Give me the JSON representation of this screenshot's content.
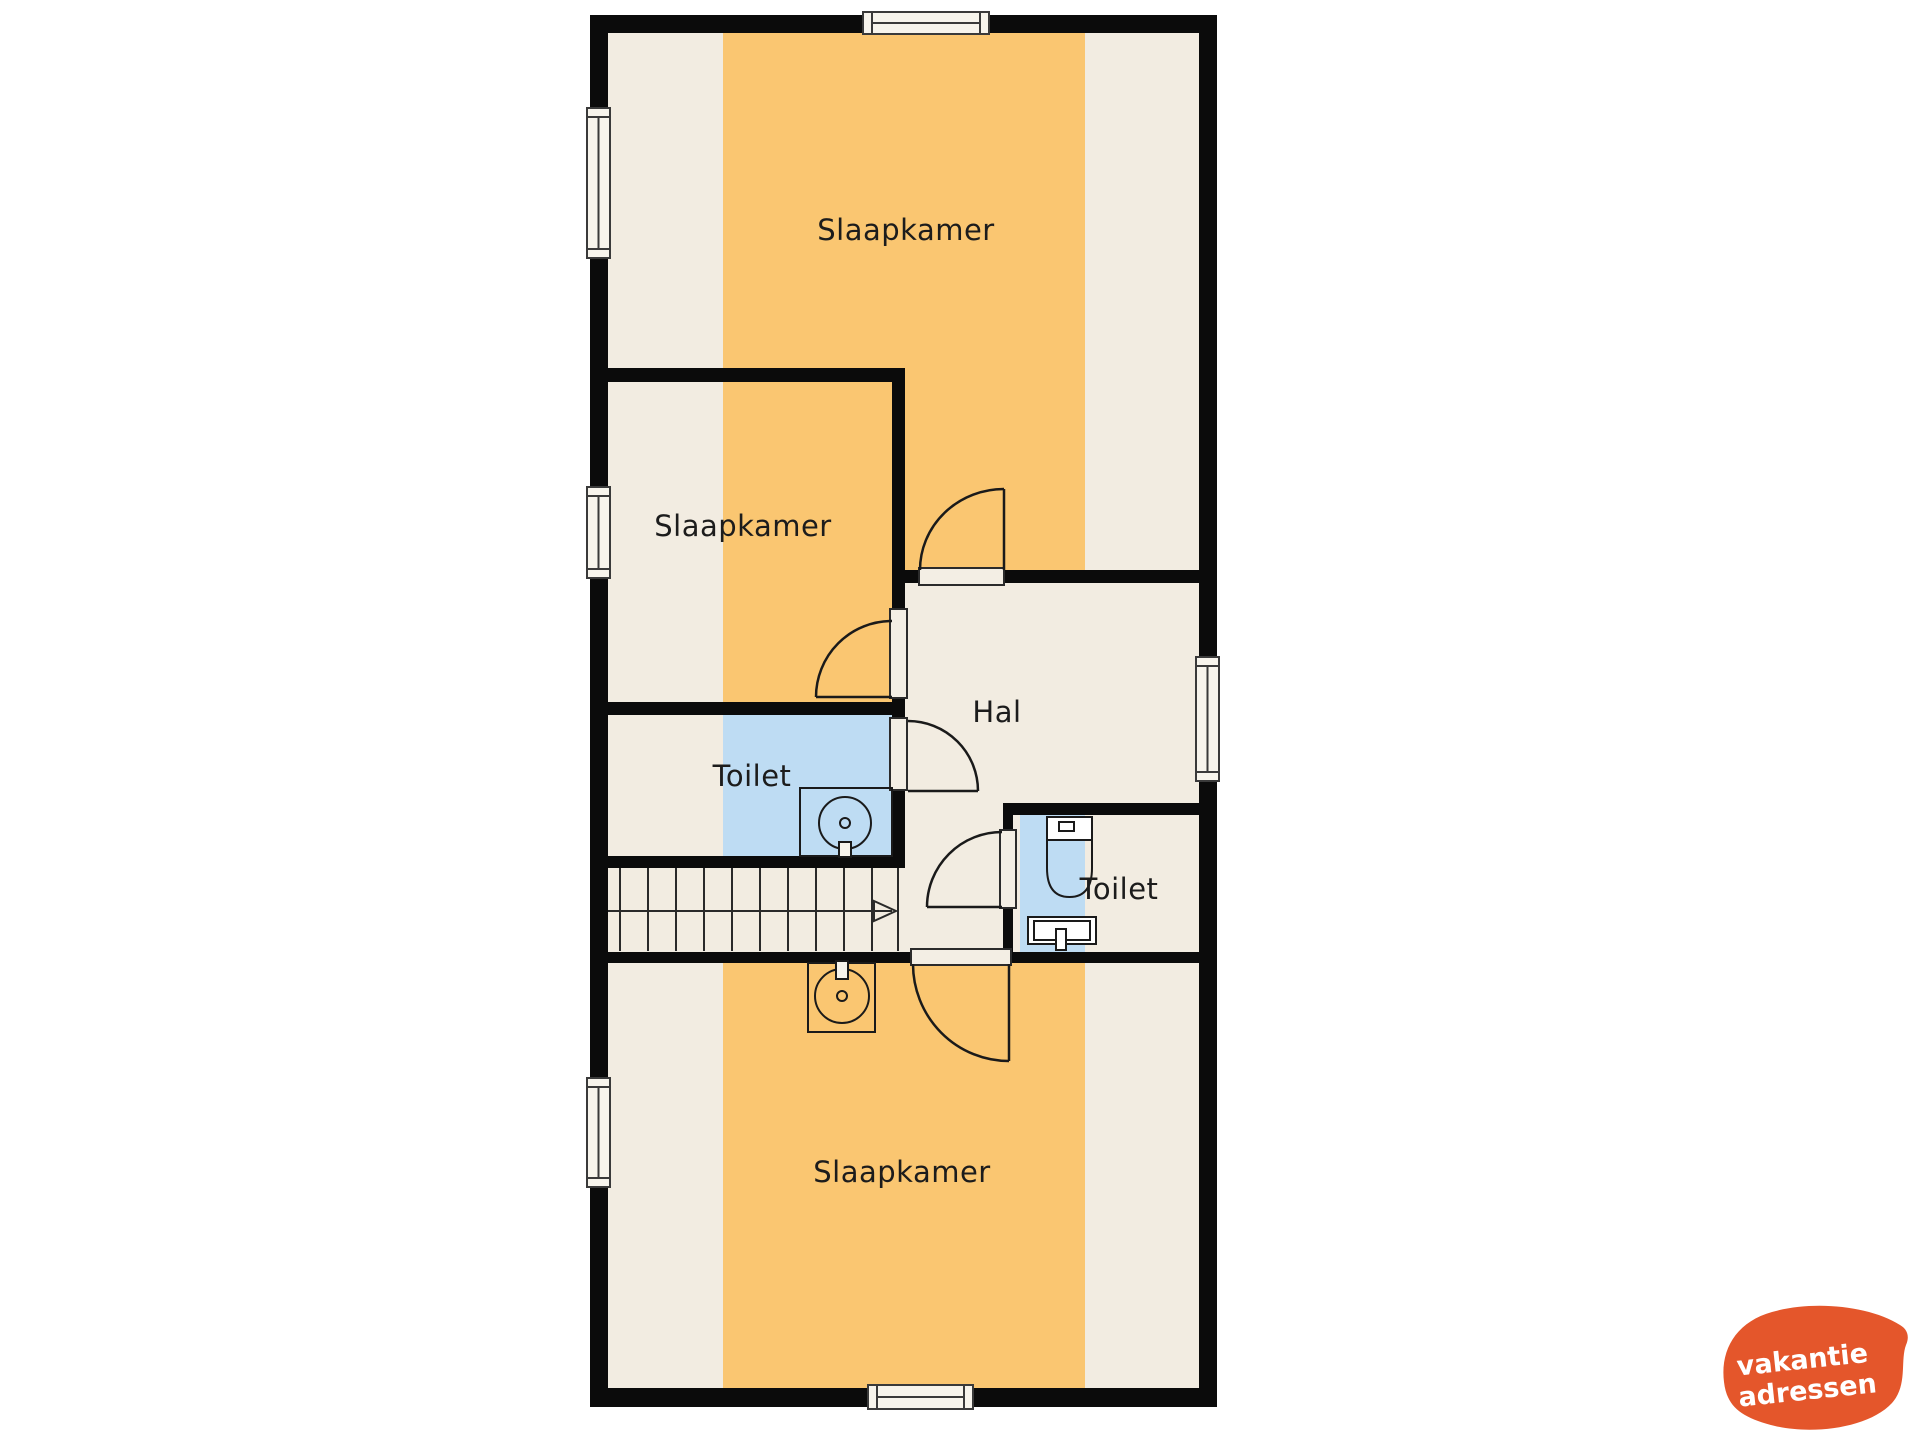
{
  "plan": {
    "rooms": [
      {
        "id": "slaapkamer-top",
        "label": "Slaapkamer"
      },
      {
        "id": "slaapkamer-middle",
        "label": "Slaapkamer"
      },
      {
        "id": "toilet-left",
        "label": "Toilet"
      },
      {
        "id": "hal",
        "label": "Hal"
      },
      {
        "id": "toilet-right",
        "label": "Toilet"
      },
      {
        "id": "slaapkamer-bottom",
        "label": "Slaapkamer"
      }
    ]
  },
  "colors": {
    "wall": "#0b0b0b",
    "floor": "#f2ece1",
    "bedroom_stripe": "#fac671",
    "toilet_blue": "#bedcf3",
    "line": "#1a1a1a",
    "logo_background": "#e4562b",
    "logo_text": "#ffffff"
  },
  "logo": {
    "line1": "vakantie",
    "line2": "adressen"
  }
}
